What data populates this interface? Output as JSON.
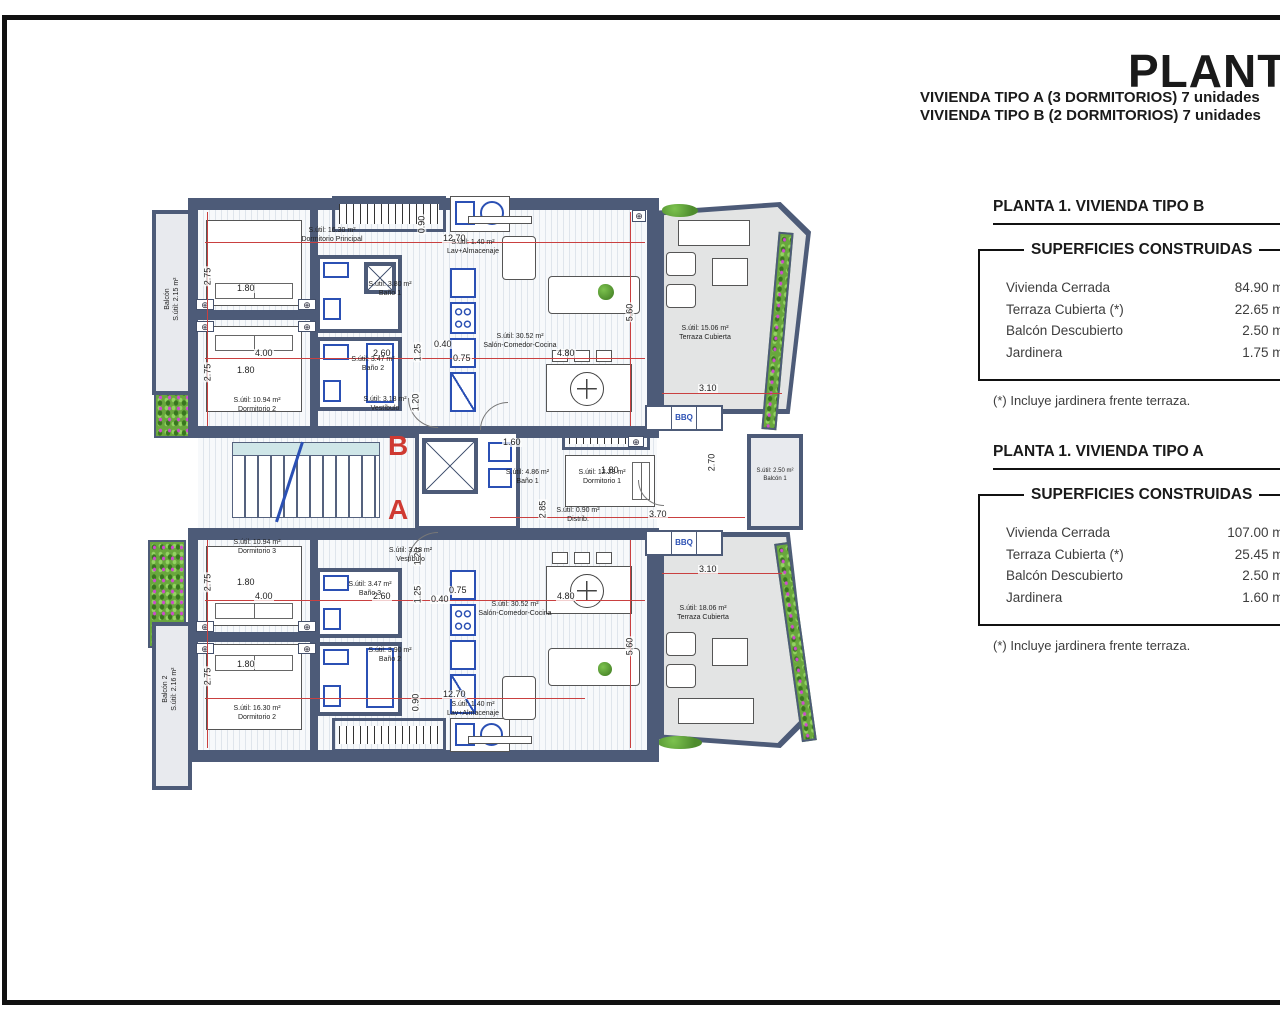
{
  "header": {
    "title": "PLANTA 1",
    "subtitle_a": "VIVIENDA TIPO A (3 DORMITORIOS) 7 unidades",
    "subtitle_b": "VIVIENDA TIPO B (2 DORMITORIOS) 7 unidades"
  },
  "panels": {
    "tipo_b": {
      "title": "PLANTA 1. VIVIENDA TIPO B",
      "table_heading": "SUPERFICIES CONSTRUIDAS",
      "rows": [
        {
          "label": "Vivienda Cerrada",
          "value": "84.90 m²"
        },
        {
          "label": "Terraza Cubierta (*)",
          "value": "22.65 m²"
        },
        {
          "label": "Balcón Descubierto",
          "value": "2.50 m²"
        },
        {
          "label": "Jardinera",
          "value": "1.75 m²"
        }
      ],
      "footnote": "(*) Incluye jardinera frente terraza."
    },
    "tipo_a": {
      "title": "PLANTA 1. VIVIENDA TIPO A",
      "table_heading": "SUPERFICIES CONSTRUIDAS",
      "rows": [
        {
          "label": "Vivienda Cerrada",
          "value": "107.00 m²"
        },
        {
          "label": "Terraza Cubierta (*)",
          "value": "25.45 m²"
        },
        {
          "label": "Balcón Descubierto",
          "value": "2.50 m²"
        },
        {
          "label": "Jardinera",
          "value": "1.60 m²"
        }
      ],
      "footnote": "(*) Incluye jardinera frente terraza."
    }
  },
  "plan": {
    "rooms": {
      "b_dorm_principal": {
        "area": "S.útil: 16.30 m²",
        "name": "Dormitorio Principal"
      },
      "b_lav": {
        "area": "S.útil: 1.40 m²",
        "name": "Lav+Almacenaje"
      },
      "b_bano1": {
        "area": "S.útil: 3.80 m²",
        "name": "Baño 1"
      },
      "b_bano2": {
        "area": "S.útil: 3.47 m²",
        "name": "Baño 2"
      },
      "b_vestibulo": {
        "area": "S.útil: 3.18 m²",
        "name": "Vestíbulo"
      },
      "b_dorm2": {
        "area": "S.útil: 10.94 m²",
        "name": "Dormitorio 2"
      },
      "b_salon": {
        "area": "S.útil: 30.52 m²",
        "name": "Salón-Comedor-Cocina"
      },
      "b_terraza": {
        "area": "S.útil: 15.06 m²",
        "name": "Terraza Cubierta"
      },
      "b_balcon": {
        "area": "S.útil: 2.15 m²",
        "name": "Balcón"
      },
      "a_bano1": {
        "area": "S.útil: 4.86 m²",
        "name": "Baño 1"
      },
      "a_dorm1": {
        "area": "S.útil: 12.23 m²",
        "name": "Dormitorio 1"
      },
      "a_distrib": {
        "area": "S.útil: 0.90 m²",
        "name": "Distrib."
      },
      "a_balcon1": {
        "area": "S.útil: 2.50 m²",
        "name": "Balcón 1"
      },
      "a_dorm3": {
        "area": "S.útil: 10.94 m²",
        "name": "Dormitorio 3"
      },
      "a_vestibulo": {
        "area": "S.útil: 3.18 m²",
        "name": "Vestíbulo"
      },
      "a_bano3": {
        "area": "S.útil: 3.47 m²",
        "name": "Baño 3"
      },
      "a_bano2": {
        "area": "S.útil: 3.90 m²",
        "name": "Baño 2"
      },
      "a_dorm2": {
        "area": "S.útil: 16.30 m²",
        "name": "Dormitorio 2"
      },
      "a_salon": {
        "area": "S.útil: 30.52 m²",
        "name": "Salón-Comedor-Cocina"
      },
      "a_terraza": {
        "area": "S.útil: 18.06 m²",
        "name": "Terraza Cubierta"
      },
      "a_lav": {
        "area": "S.útil: 1.40 m²",
        "name": "Lav+Almacenaje"
      },
      "a_balcon2": {
        "area": "S.útil: 2.16 m²",
        "name": "Balcón 2"
      }
    },
    "dims": {
      "d275": "2.75",
      "d180": "1.80",
      "d400": "4.00",
      "d1270": "12.70",
      "d090": "0.90",
      "d260": "2.60",
      "d125": "1.25",
      "d040": "0.40",
      "d075": "0.75",
      "d480": "4.80",
      "d560": "5.60",
      "d310": "3.10",
      "d160": "1.60",
      "d285": "2.85",
      "d370": "3.70",
      "d270": "2.70",
      "d120": "1.20"
    },
    "markers": {
      "section_a": "A",
      "section_b": "B",
      "bbq": "BBQ"
    }
  },
  "colors": {
    "wall": "#4d5b78",
    "dim_red": "#c94040",
    "fixture_blue": "#2b50b4",
    "terrace_gray": "#e3e4e4",
    "plant_green": "#69a73d",
    "flower_magenta": "#cf49cf",
    "marker_red": "#cf3a32"
  }
}
